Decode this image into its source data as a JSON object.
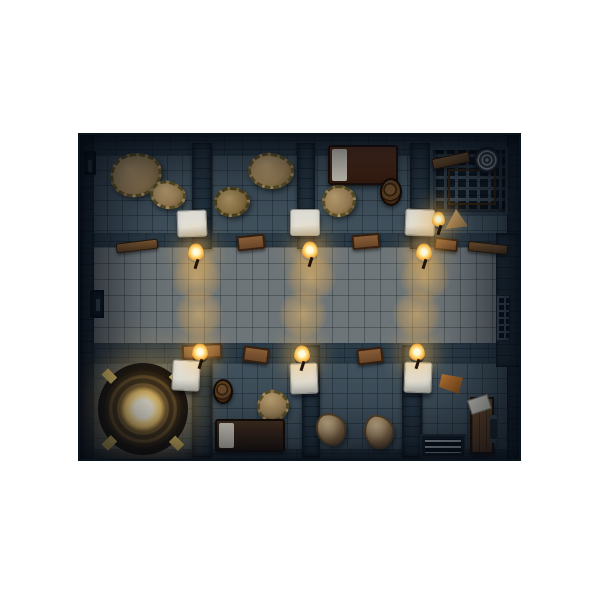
{
  "scene": {
    "title": "top-down-dungeon-prison-map",
    "background": "#ffffff",
    "map": {
      "x": 78,
      "y": 133,
      "width": 443,
      "height": 328
    },
    "palette": {
      "frame": "#101b26",
      "wall": "#2b3c49",
      "wallDark": "#233340",
      "floorCell": "#41525e",
      "corridor": "#6d7579",
      "doorLight": "#e0dfd8",
      "torchGlow": "#ffc864",
      "hay": "#a3865a",
      "hayHi": "#c8ab79",
      "magicGold": "#eec269",
      "magicGlow": "#fff3c8",
      "wood": "#835c36",
      "bedBlanketTop": "#4e2b1b",
      "bedBlanketBottom": "#3a281c",
      "pillow": "#e0dbcc"
    },
    "elements": [
      {
        "name": "outer-wall-top",
        "type": "wall-band",
        "x": 0,
        "y": 0,
        "w": 443,
        "h": 24
      },
      {
        "name": "cells-floor-top",
        "type": "floor",
        "x": 12,
        "y": 20,
        "w": 419,
        "h": 86
      },
      {
        "name": "corridor-wall-top",
        "type": "wall-band",
        "x": 12,
        "y": 98,
        "w": 419,
        "h": 18
      },
      {
        "name": "corridor-floor",
        "type": "corridor",
        "x": 12,
        "y": 112,
        "w": 406,
        "h": 100
      },
      {
        "name": "corridor-wall-bottom",
        "type": "wall-band",
        "x": 12,
        "y": 208,
        "w": 419,
        "h": 24
      },
      {
        "name": "cells-floor-bottom",
        "type": "floor",
        "x": 12,
        "y": 228,
        "w": 419,
        "h": 92
      },
      {
        "name": "outer-wall-bottom",
        "type": "wall-band",
        "x": 0,
        "y": 314,
        "w": 443,
        "h": 14
      },
      {
        "name": "outer-wall-left",
        "type": "wall-side",
        "x": 0,
        "y": 0,
        "w": 14,
        "h": 328
      },
      {
        "name": "outer-wall-right",
        "type": "wall-side",
        "x": 427,
        "y": 0,
        "w": 16,
        "h": 328
      },
      {
        "name": "corridor-right-wall",
        "type": "wall-side",
        "x": 416,
        "y": 98,
        "w": 27,
        "h": 134
      },
      {
        "name": "cell-divider-top-1",
        "type": "wall-divider",
        "x": 112,
        "y": 8,
        "w": 20,
        "h": 106
      },
      {
        "name": "cell-divider-top-2",
        "type": "wall-divider",
        "x": 217,
        "y": 8,
        "w": 18,
        "h": 106
      },
      {
        "name": "cell-divider-top-3",
        "type": "wall-divider",
        "x": 330,
        "y": 8,
        "w": 20,
        "h": 106
      },
      {
        "name": "cell-divider-bottom-1",
        "type": "wall-divider",
        "x": 112,
        "y": 210,
        "w": 20,
        "h": 112
      },
      {
        "name": "cell-divider-bottom-2",
        "type": "wall-divider",
        "x": 222,
        "y": 210,
        "w": 18,
        "h": 112
      },
      {
        "name": "cell-divider-bottom-3",
        "type": "wall-divider",
        "x": 322,
        "y": 210,
        "w": 20,
        "h": 112
      },
      {
        "name": "torch-light-pool",
        "type": "light-pool",
        "x": 85,
        "y": 112,
        "w": 64,
        "h": 62
      },
      {
        "name": "torch-light-pool",
        "type": "light-pool",
        "x": 199,
        "y": 112,
        "w": 64,
        "h": 62
      },
      {
        "name": "torch-light-pool",
        "type": "light-pool",
        "x": 313,
        "y": 112,
        "w": 64,
        "h": 62
      },
      {
        "name": "torch-light-pool",
        "type": "light-pool",
        "x": 88,
        "y": 148,
        "w": 62,
        "h": 62
      },
      {
        "name": "torch-light-pool",
        "type": "light-pool",
        "x": 192,
        "y": 148,
        "w": 62,
        "h": 62
      },
      {
        "name": "torch-light-pool",
        "type": "light-pool",
        "x": 306,
        "y": 148,
        "w": 62,
        "h": 62
      },
      {
        "name": "hay-pile",
        "type": "hay",
        "x": 30,
        "y": 18,
        "w": 52,
        "h": 44,
        "rot": -10
      },
      {
        "name": "hay-pile",
        "type": "hay",
        "x": 70,
        "y": 46,
        "w": 36,
        "h": 28,
        "rot": 15
      },
      {
        "name": "hay-pile-spiky",
        "type": "hay-spiky",
        "x": 134,
        "y": 52,
        "w": 36,
        "h": 30
      },
      {
        "name": "hay-pile",
        "type": "hay",
        "x": 168,
        "y": 18,
        "w": 46,
        "h": 36,
        "rot": 8
      },
      {
        "name": "bed",
        "type": "bed-a",
        "x": 248,
        "y": 10,
        "w": 70,
        "h": 40
      },
      {
        "name": "hay-pile",
        "type": "hay",
        "x": 242,
        "y": 50,
        "w": 34,
        "h": 32,
        "rot": -5
      },
      {
        "name": "barrel",
        "type": "barrel",
        "x": 300,
        "y": 43,
        "w": 22,
        "h": 28
      },
      {
        "name": "cage-grate",
        "type": "cage",
        "x": 350,
        "y": 12,
        "w": 78,
        "h": 68
      },
      {
        "name": "cage-wood-platform",
        "type": "platform",
        "x": 368,
        "y": 34,
        "w": 48,
        "h": 36
      },
      {
        "name": "wood-beam",
        "type": "beam",
        "x": 352,
        "y": 20,
        "w": 38,
        "h": 11,
        "rot": -12
      },
      {
        "name": "rope-coil",
        "type": "rope",
        "x": 394,
        "y": 12,
        "w": 26,
        "h": 26,
        "rot": 20
      },
      {
        "name": "small-sack",
        "type": "sack-tri",
        "x": 364,
        "y": 74,
        "w": 24,
        "h": 20
      },
      {
        "name": "magic-circle",
        "type": "magic",
        "x": 18,
        "y": 228,
        "w": 90,
        "h": 92
      },
      {
        "name": "barrel",
        "type": "barrel",
        "x": 133,
        "y": 244,
        "w": 20,
        "h": 25
      },
      {
        "name": "hay-pile",
        "type": "hay",
        "x": 177,
        "y": 255,
        "w": 32,
        "h": 32,
        "rot": 12
      },
      {
        "name": "bed",
        "type": "bed-b",
        "x": 135,
        "y": 284,
        "w": 70,
        "h": 33
      },
      {
        "name": "hay-sack",
        "type": "sack",
        "x": 236,
        "y": 278,
        "w": 30,
        "h": 33,
        "rot": -4
      },
      {
        "name": "hay-sack",
        "type": "sack",
        "x": 284,
        "y": 280,
        "w": 30,
        "h": 34,
        "rot": 6
      },
      {
        "name": "orange-cloth",
        "type": "cloth",
        "x": 359,
        "y": 239,
        "w": 24,
        "h": 20
      },
      {
        "name": "wooden-stocks-door",
        "type": "stocks",
        "x": 390,
        "y": 262,
        "w": 24,
        "h": 57
      },
      {
        "name": "grate-stairs",
        "type": "stairs",
        "x": 340,
        "y": 299,
        "w": 46,
        "h": 24
      },
      {
        "name": "left-wall-door",
        "type": "ldoor",
        "x": 10,
        "y": 155,
        "w": 14,
        "h": 28
      },
      {
        "name": "wall-recess",
        "type": "ldoor",
        "x": 4,
        "y": 16,
        "w": 12,
        "h": 24
      },
      {
        "name": "wall-grate",
        "type": "wgrate",
        "x": 416,
        "y": 160,
        "w": 14,
        "h": 46
      },
      {
        "name": "wood-shelf",
        "type": "tray",
        "x": 102,
        "y": 209,
        "w": 40,
        "h": 15,
        "rot": -3
      },
      {
        "name": "wood-tray",
        "type": "tray",
        "x": 157,
        "y": 100,
        "w": 28,
        "h": 15,
        "rot": -6
      },
      {
        "name": "wood-tray",
        "type": "tray",
        "x": 272,
        "y": 99,
        "w": 28,
        "h": 15,
        "rot": -5
      },
      {
        "name": "wood-tray",
        "type": "tray",
        "x": 354,
        "y": 103,
        "w": 24,
        "h": 13,
        "rot": 6
      },
      {
        "name": "wood-tray",
        "type": "tray",
        "x": 163,
        "y": 212,
        "w": 26,
        "h": 16,
        "rot": 8
      },
      {
        "name": "wood-tray",
        "type": "tray",
        "x": 277,
        "y": 213,
        "w": 26,
        "h": 16,
        "rot": -7
      },
      {
        "name": "wood-beam",
        "type": "beam",
        "x": 36,
        "y": 106,
        "w": 42,
        "h": 10,
        "rot": -7
      },
      {
        "name": "wood-beam",
        "type": "beam",
        "x": 388,
        "y": 108,
        "w": 40,
        "h": 10,
        "rot": 6
      },
      {
        "name": "cell-door",
        "type": "door",
        "x": 97,
        "y": 75,
        "w": 30,
        "h": 27,
        "rot": -2
      },
      {
        "name": "cell-door",
        "type": "door",
        "x": 210,
        "y": 74,
        "w": 30,
        "h": 27
      },
      {
        "name": "cell-door",
        "type": "door",
        "x": 325,
        "y": 74,
        "w": 30,
        "h": 27,
        "rot": 2
      },
      {
        "name": "cell-door",
        "type": "door",
        "x": 92,
        "y": 225,
        "w": 28,
        "h": 31,
        "rot": 3
      },
      {
        "name": "cell-door",
        "type": "door",
        "x": 210,
        "y": 228,
        "w": 28,
        "h": 31,
        "rot": -2
      },
      {
        "name": "cell-door",
        "type": "door",
        "x": 324,
        "y": 227,
        "w": 28,
        "h": 31,
        "rot": 2
      },
      {
        "name": "wall-torch",
        "type": "torch",
        "x": 108,
        "y": 108,
        "w": 16,
        "h": 20
      },
      {
        "name": "wall-torch",
        "type": "torch",
        "x": 222,
        "y": 106,
        "w": 16,
        "h": 20
      },
      {
        "name": "wall-torch",
        "type": "torch",
        "x": 336,
        "y": 108,
        "w": 16,
        "h": 20
      },
      {
        "name": "wall-torch",
        "type": "torch",
        "x": 112,
        "y": 208,
        "w": 16,
        "h": 20
      },
      {
        "name": "wall-torch",
        "type": "torch",
        "x": 214,
        "y": 210,
        "w": 16,
        "h": 20
      },
      {
        "name": "wall-torch",
        "type": "torch",
        "x": 329,
        "y": 208,
        "w": 16,
        "h": 20
      },
      {
        "name": "wall-torch",
        "type": "torch",
        "x": 352,
        "y": 76,
        "w": 13,
        "h": 18
      },
      {
        "name": "shadow-vignette",
        "type": "vignette",
        "x": 0,
        "y": 0,
        "w": 443,
        "h": 328
      }
    ]
  }
}
